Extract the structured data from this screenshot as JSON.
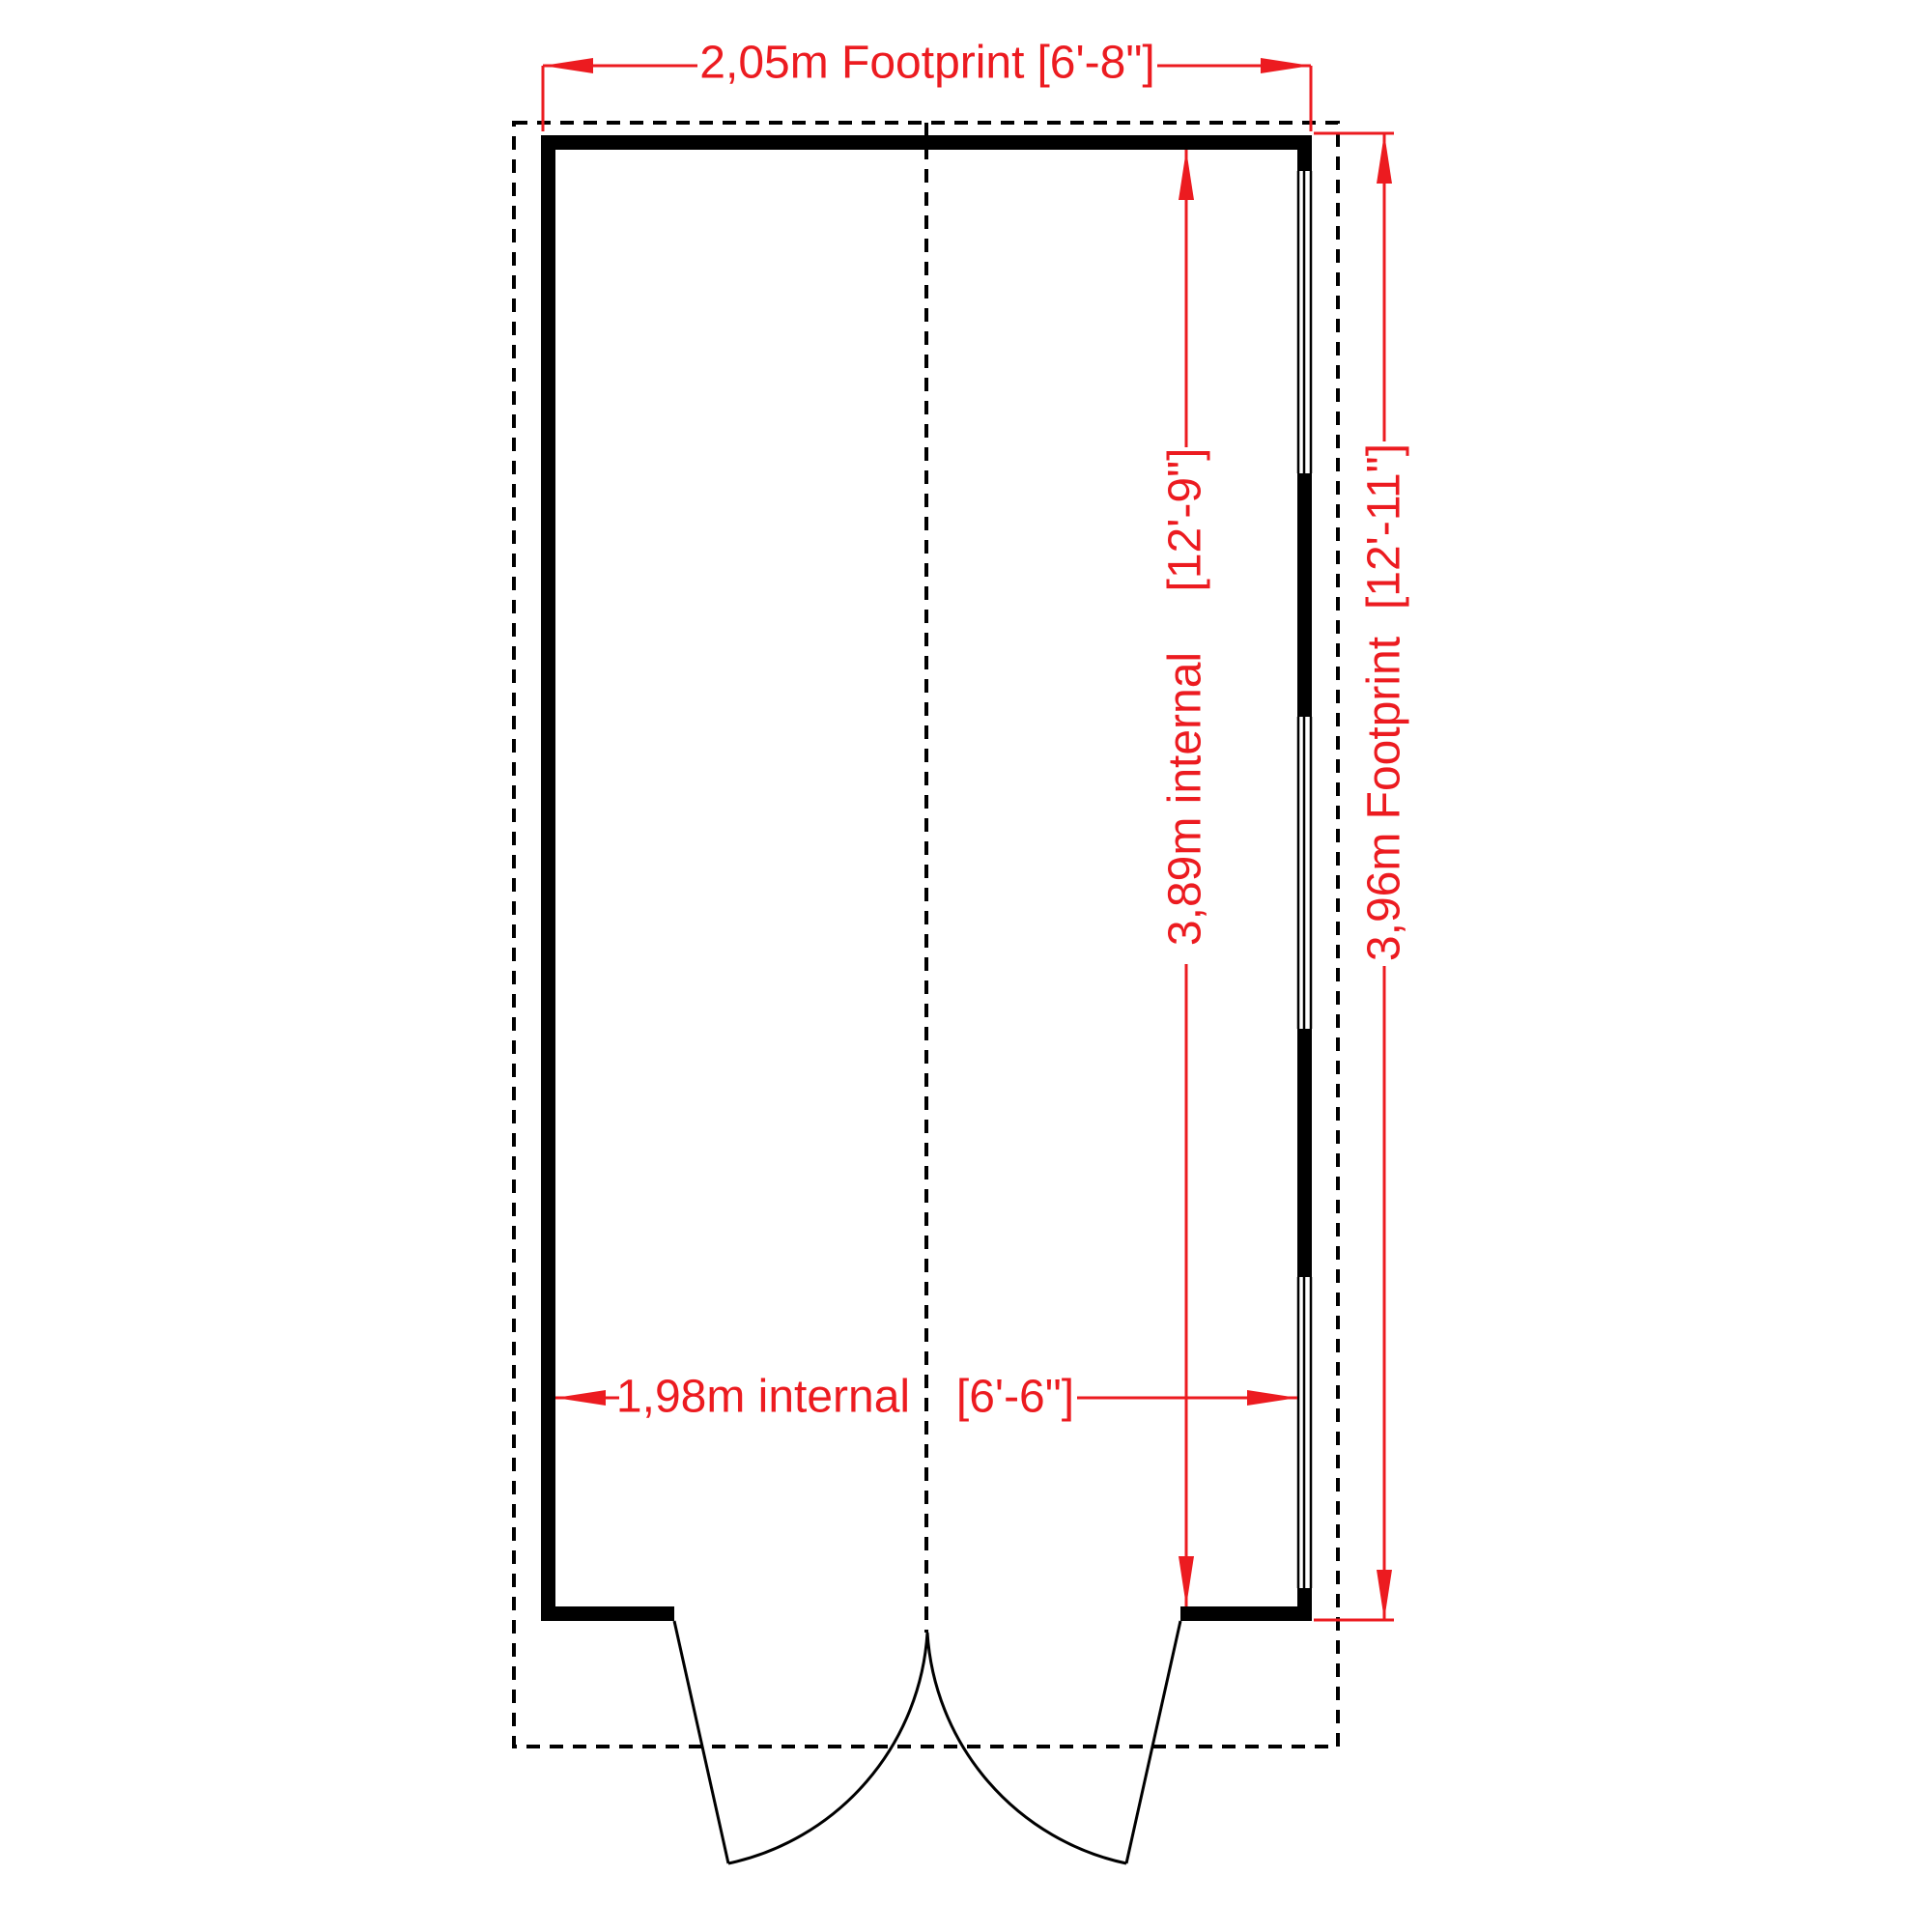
{
  "colors": {
    "dimension_red": "#ec1b20",
    "line_black": "#000000",
    "background": "#ffffff"
  },
  "dimensions": {
    "width_footprint": {
      "metric": "2,05m Footprint",
      "imperial": "[6'-8\"]"
    },
    "width_internal": {
      "metric": "1,98m internal",
      "imperial": "[6'-6\"]"
    },
    "height_internal": {
      "metric": "3,89m internal",
      "imperial": "[12'-9\"]"
    },
    "height_footprint": {
      "metric": "3,96m Footprint",
      "imperial": "[12'-11\"]"
    }
  }
}
